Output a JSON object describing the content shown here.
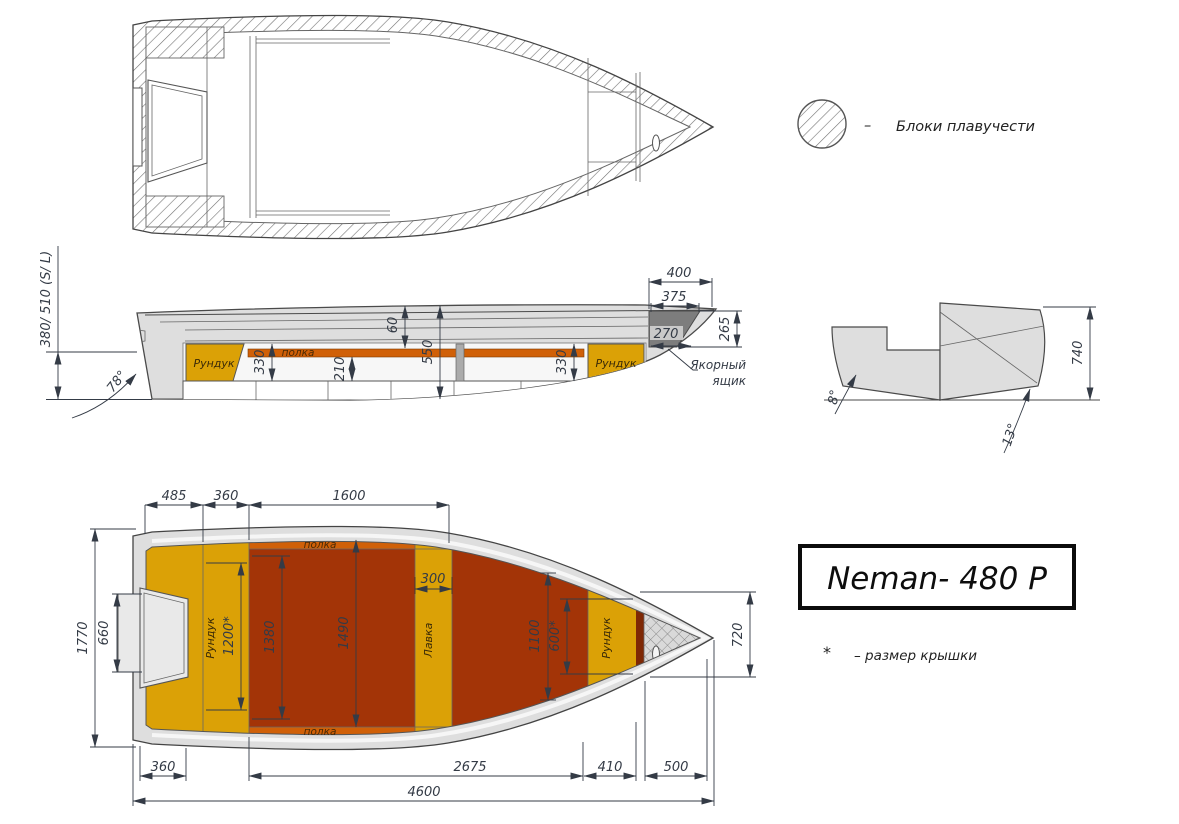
{
  "legend": {
    "dash": "–",
    "label": "Блоки плавучести"
  },
  "title": {
    "text": "Neman- 480 P"
  },
  "note": {
    "marker": "*",
    "text": "– размер крышки"
  },
  "side": {
    "locker_left": "Рундук",
    "locker_right": "Рундук",
    "shelf": "полка",
    "anchor_line1": "Якорный",
    "anchor_line2": "ящик",
    "stern_height": "380/ 510 (S/ L)",
    "transom_angle": "78°",
    "d330l": "330",
    "d210": "210",
    "d60": "60",
    "d550": "550",
    "d330r": "330",
    "d400": "400",
    "d375": "375",
    "d270": "270",
    "d265": "265"
  },
  "section": {
    "d740": "740",
    "angle_left": "8°",
    "angle_right": "13°"
  },
  "plan": {
    "shelf_top": "полка",
    "shelf_bottom": "полка",
    "locker_aft": "Рундук",
    "bench": "Лавка",
    "locker_bow": "Рундук",
    "d485": "485",
    "d360t": "360",
    "d1600": "1600",
    "d1770": "1770",
    "d660": "660",
    "d1200": "1200*",
    "d1380": "1380",
    "d1490": "1490",
    "d300": "300",
    "d1100": "1100",
    "d600": "600*",
    "d720": "720",
    "d360b": "360",
    "d2675": "2675",
    "d410": "410",
    "d500": "500",
    "d4600": "4600"
  },
  "colors": {
    "hull": "#dedede",
    "yellow": "#dba106",
    "orange": "#d06008",
    "red": "#a33407",
    "dark_red": "#7e2805",
    "anchor_gray": "#7d7d7d",
    "cutout": "#e9e9e9",
    "white": "#ffffff"
  }
}
